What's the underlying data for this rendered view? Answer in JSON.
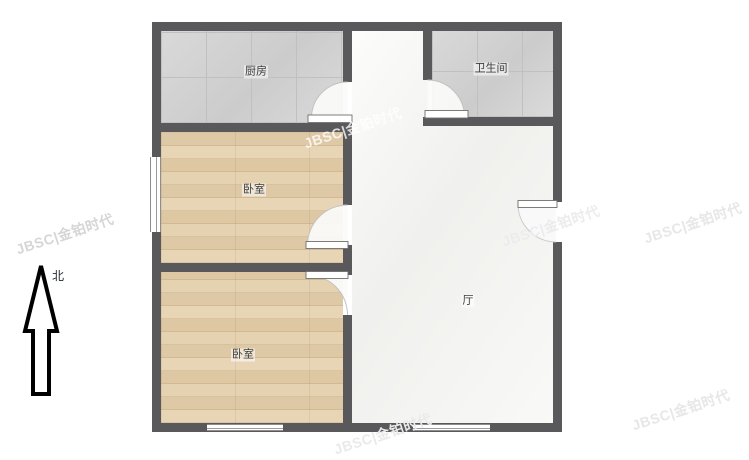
{
  "title": "两居室户型图",
  "compass": {
    "label": "北"
  },
  "rooms": {
    "kitchen": {
      "label": "厨房"
    },
    "bathroom": {
      "label": "卫生间"
    },
    "bedroom_upper": {
      "label": "卧室"
    },
    "bedroom_lower": {
      "label": "卧室"
    },
    "hall": {
      "label": "厅"
    }
  },
  "watermark": {
    "text": "JBSC|金铂时代"
  },
  "colors": {
    "wall": "#59595b",
    "tile": "#d2d2d2",
    "wood": "#e4d0ae",
    "hall": "#f6f6f4"
  }
}
